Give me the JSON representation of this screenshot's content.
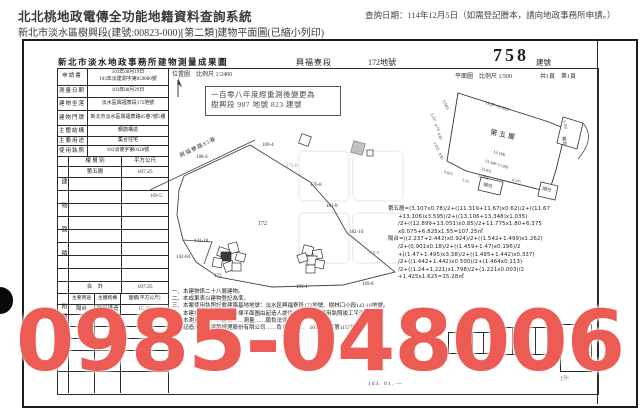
{
  "app": {
    "system_title": "北北桃地政電傳全功能地籍資料查詢系統",
    "query_date_label": "查詢日期：114年12月5日（如需登記謄本，請向地政事務所申請。）",
    "document_title": "新北市淡水區樹興段(建號:00823-000)[第二類]建物平面圖(已縮小列印)"
  },
  "form_header": {
    "office_title": "新北市淡水地政事務所建物測量成果圖",
    "section_name": "興福寮段",
    "land_no": "172地號",
    "building_no": "758",
    "building_no_unit": "建號",
    "plan_info": "平面圖　比例尺 1/500",
    "page_info": "共1頁　第1頁",
    "location_map_info": "位置圖　比例尺 1/2400",
    "rescale_stamp_line1": "一百零八年度經重測後變更為",
    "rescale_stamp_line2": "樹興段 987 地號 823 建號"
  },
  "info_table": {
    "rows": [
      {
        "label": "申請書",
        "value": "103年08月19日",
        "value2": "103年淡建測字第059880號"
      },
      {
        "label": "測量日期",
        "value": "103年08月29日",
        "value2": ""
      },
      {
        "label": "建物坐落",
        "value": "淡水區興福寮段172地號",
        "value2": ""
      },
      {
        "label": "建物門牌",
        "value": "新北市淡水區興福寮路85巷7號5樓",
        "value2": ""
      },
      {
        "label": "主體結構",
        "value": "鋼筋構造",
        "value2": ""
      },
      {
        "label": "主要用途",
        "value": "集合住宅",
        "value2": ""
      },
      {
        "label": "使用執照",
        "value": "103淡使字第0320號",
        "value2": ""
      }
    ]
  },
  "area_table": {
    "section_label": "建物面積",
    "col1": "樓 層 別",
    "col2": "平方公尺",
    "floor_label": "第五層",
    "floor_area": "107.25",
    "total_label": "合　計",
    "total_area": "107.25"
  },
  "annex_table": {
    "section_label": "附屬建物",
    "col1": "主要用途",
    "col2": "主體結構",
    "col3": "面積(平方公尺)",
    "use": "陽台",
    "structure": "鋼筋構造",
    "area": "15.28",
    "total_area": "15.28"
  },
  "location_map": {
    "road_label": "興福寮路85巷",
    "parcels": [
      "188-4",
      "169-4",
      "169-5",
      "172-8",
      "176-8",
      "181-8",
      "172",
      "182-10",
      "142-18",
      "142-84",
      "172",
      "195-1",
      "169-8",
      "118-8"
    ]
  },
  "floor_plan": {
    "floor_label": "第五層",
    "balcony_label": "陽台",
    "dims": [
      "11.67~11.319",
      "3.595",
      "3.107",
      "0.78",
      "0.62",
      "1.035",
      "13.106",
      "13.348~12.899",
      "13.051",
      "6.375",
      "11.775",
      "6.825",
      "1.55",
      "5.302",
      "0.85"
    ]
  },
  "calculations": {
    "lines": [
      "第五層=(3.107x0.78)/2+((11.319+11.67)x0.62)/2+((11.67",
      "+13.106)x3.595)/2+((13.106+13.348)x1.035)",
      "/2+((12.899+13.051)x0.85)/2+11.775x1.80+6.375",
      "x0.075+6.825x1.55=107.25㎡",
      "陽台=((2.237+2.442)x0.924)/2+((1.542+1.499)x1.262)",
      "/2+(0.901x0.18)/2+((1.459+1.47)x0.196)/2",
      "+((1.47+1.495)x3.38)/2+((1.495+1.442)x0.337)",
      "/2+((1.442+1.442)x0.500)/2+(1.464x0.113)",
      "/2+((1.24+1.221)x1.798)/2+(1.221x0.003)/2",
      "+1.425x1.625=15.28㎡"
    ]
  },
  "notes": {
    "lines": [
      "一、本建物係二十八層建物。",
      "二、本成果表以建物登記為準。",
      "三、本案使用執照記載建築基地地號：淡水區興福寮段172地號、樹林口小段142-18地號。",
      "　　本建物位置圖及建物各棟平面圖由起造人提供，經核對與使用執照竣工平面圖相符。",
      "　　本測量成果……建物……測量……願負法律責任。",
      "　　起造人……建築經理股份有限公司……負責人……　103淡使字第1157號"
    ]
  },
  "seals": {
    "tall_seal_text": "為行"
  },
  "footer": {
    "plot_date": "103. 01. ―",
    "handwritten_mark": "19-"
  },
  "watermark": {
    "phone": "0985-048006",
    "color": "#ec5c54"
  }
}
